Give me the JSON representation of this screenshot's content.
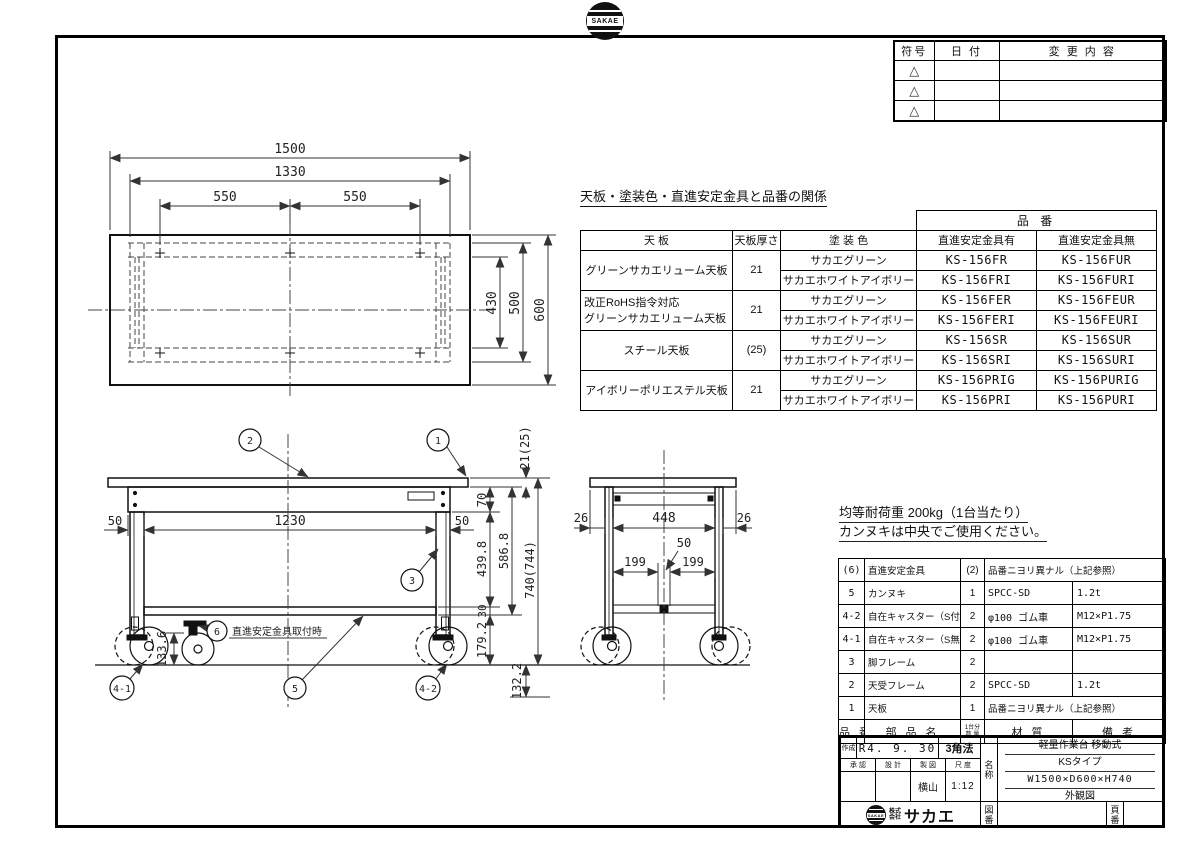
{
  "logos": {
    "badge_text": "SAKAE",
    "company_line1": "株式",
    "company_line2": "会社",
    "company_name": "サカエ"
  },
  "revision_table": {
    "col_symbol": "符号",
    "col_date": "日 付",
    "col_content": "変 更 内 容",
    "triangle": "△"
  },
  "spec_table": {
    "title": "天板・塗装色・直進安定金具と品番の関係",
    "h_hinban": "品 番",
    "h_tenban": "天 板",
    "h_thickness": "天板厚さ",
    "h_paint": "塗 装 色",
    "h_with": "直進安定金具有",
    "h_without": "直進安定金具無",
    "g1_tenban": "グリーンサカエリューム天板",
    "g1_thickness": "21",
    "g1_paint1": "サカエグリーン",
    "g1_with1": "KS-156FR",
    "g1_without1": "KS-156FUR",
    "g1_paint2": "サカエホワイトアイボリー",
    "g1_with2": "KS-156FRI",
    "g1_without2": "KS-156FURI",
    "g2_tenban1": "改正RoHS指令対応",
    "g2_tenban2": "グリーンサカエリューム天板",
    "g2_thickness": "21",
    "g2_paint1": "サカエグリーン",
    "g2_with1": "KS-156FER",
    "g2_without1": "KS-156FEUR",
    "g2_paint2": "サカエホワイトアイボリー",
    "g2_with2": "KS-156FERI",
    "g2_without2": "KS-156FEURI",
    "g3_tenban": "スチール天板",
    "g3_thickness": "(25)",
    "g3_paint1": "サカエグリーン",
    "g3_with1": "KS-156SR",
    "g3_without1": "KS-156SUR",
    "g3_paint2": "サカエホワイトアイボリー",
    "g3_with2": "KS-156SRI",
    "g3_without2": "KS-156SURI",
    "g4_tenban": "アイボリーポリエステル天板",
    "g4_thickness": "21",
    "g4_paint1": "サカエグリーン",
    "g4_with1": "KS-156PRIG",
    "g4_without1": "KS-156PURIG",
    "g4_paint2": "サカエホワイトアイボリー",
    "g4_with2": "KS-156PRI",
    "g4_without2": "KS-156PURI"
  },
  "notes": {
    "load": "均等耐荷重 200kg（1台当たり）",
    "usage": "カンヌキは中央でご使用ください。"
  },
  "parts_table": {
    "h_no": "品 番",
    "h_name": "部 品 名",
    "h_qty1": "1台分",
    "h_qty2": "数 量",
    "h_material": "材  質",
    "h_remarks": "備  考",
    "r1_no": "(6)",
    "r1_name": "直進安定金具",
    "r1_qty": "(2)",
    "r1_material": "品番ニヨリ異ナル（上記参照）",
    "r2_no": "5",
    "r2_name": "カンヌキ",
    "r2_qty": "1",
    "r2_material": "SPCC-SD",
    "r2_remarks": "1.2t",
    "r3_no": "4-2",
    "r3_name": "自在キャスター（S付）",
    "r3_qty": "2",
    "r3_material": "φ100 ゴム車",
    "r3_remarks": "M12×P1.75",
    "r4_no": "4-1",
    "r4_name": "自在キャスター（S無）",
    "r4_qty": "2",
    "r4_material": "φ100 ゴム車",
    "r4_remarks": "M12×P1.75",
    "r5_no": "3",
    "r5_name": "脚フレーム",
    "r5_qty": "2",
    "r5_material": "",
    "r5_remarks": "",
    "r6_no": "2",
    "r6_name": "天受フレーム",
    "r6_qty": "2",
    "r6_material": "SPCC-SD",
    "r6_remarks": "1.2t",
    "r7_no": "1",
    "r7_name": "天板",
    "r7_qty": "1",
    "r7_material": "品番ニヨリ異ナル（上記参照）"
  },
  "title_block": {
    "created_label": "作成",
    "created_value": "R4. 9. 30",
    "projection": "3角法",
    "approved_label": "承 認",
    "designed_label": "設 計",
    "drawn_label": "製 図",
    "scale_label": "尺 度",
    "drawn_by": "横山",
    "scale_value": "1:12",
    "name_label1": "名",
    "name_label2": "称",
    "product_line1": "軽量作業台 移動式",
    "product_line2": "KSタイプ",
    "product_line3": "W1500×D600×H740",
    "product_line4": "外観図",
    "zuban1": "図",
    "zuban2": "番",
    "page1": "頁",
    "page2": "番"
  },
  "plan_view": {
    "dim_1500": "1500",
    "dim_1330": "1330",
    "dim_550_l": "550",
    "dim_550_r": "550",
    "dim_430": "430",
    "dim_500": "500",
    "dim_600": "600"
  },
  "front_view": {
    "dim_50_l": "50",
    "dim_1230": "1230",
    "dim_50_r": "50",
    "dim_21_25": "21(25)",
    "dim_70": "70",
    "dim_439_8": "439.8",
    "dim_586_8": "586.8",
    "dim_740_744": "740(744)",
    "dim_30": "30",
    "dim_179_2": "179.2",
    "dim_132_2": "132.2",
    "dim_133_6": "133.6",
    "balloon_1": "1",
    "balloon_2": "2",
    "balloon_3": "3",
    "balloon_4_1": "4-1",
    "balloon_4_2": "4-2",
    "balloon_5": "5",
    "balloon_6": "6",
    "note_6": "直進安定金具取付時"
  },
  "side_view": {
    "dim_26_l": "26",
    "dim_448": "448",
    "dim_26_r": "26",
    "dim_50": "50",
    "dim_199_l": "199",
    "dim_199_r": "199"
  }
}
